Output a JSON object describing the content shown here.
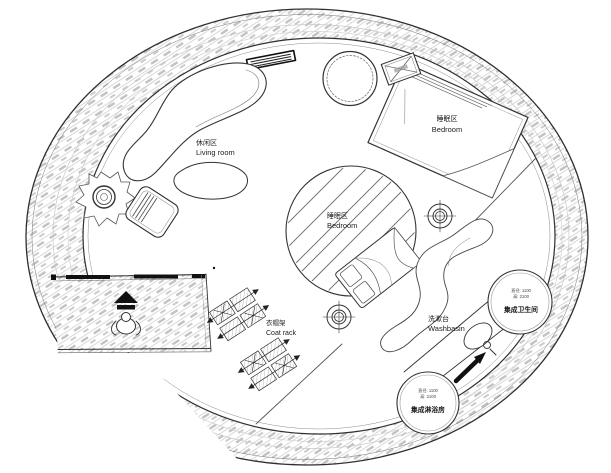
{
  "document": {
    "type": "circular floor plan",
    "style": "architectural line drawing, top view"
  },
  "labels": {
    "living": {
      "zh": "休闲区",
      "en": "Living room"
    },
    "bedroom_upper": {
      "zh": "睡眠区",
      "en": "Bedroom"
    },
    "bedroom_center": {
      "zh": "睡眠区",
      "en": "Bedroom"
    },
    "coat_rack": {
      "zh": "衣帽架",
      "en": "Coat rack"
    },
    "washbasin": {
      "zh": "洗漱台",
      "en": "Washbasin"
    },
    "bathroom_pod": {
      "name": "集成卫生间",
      "spec_diameter": "直径: 1100",
      "spec_height": "高: 2100"
    },
    "shower_pod": {
      "name": "集成淋浴房",
      "spec_diameter": "直径: 1100",
      "spec_height": "高: 2100"
    }
  },
  "colors": {
    "ink": "#2f2f2f",
    "hatch_dash": "#c2c2c2",
    "hatch_line": "#a8a8a8",
    "background": "#ffffff"
  }
}
